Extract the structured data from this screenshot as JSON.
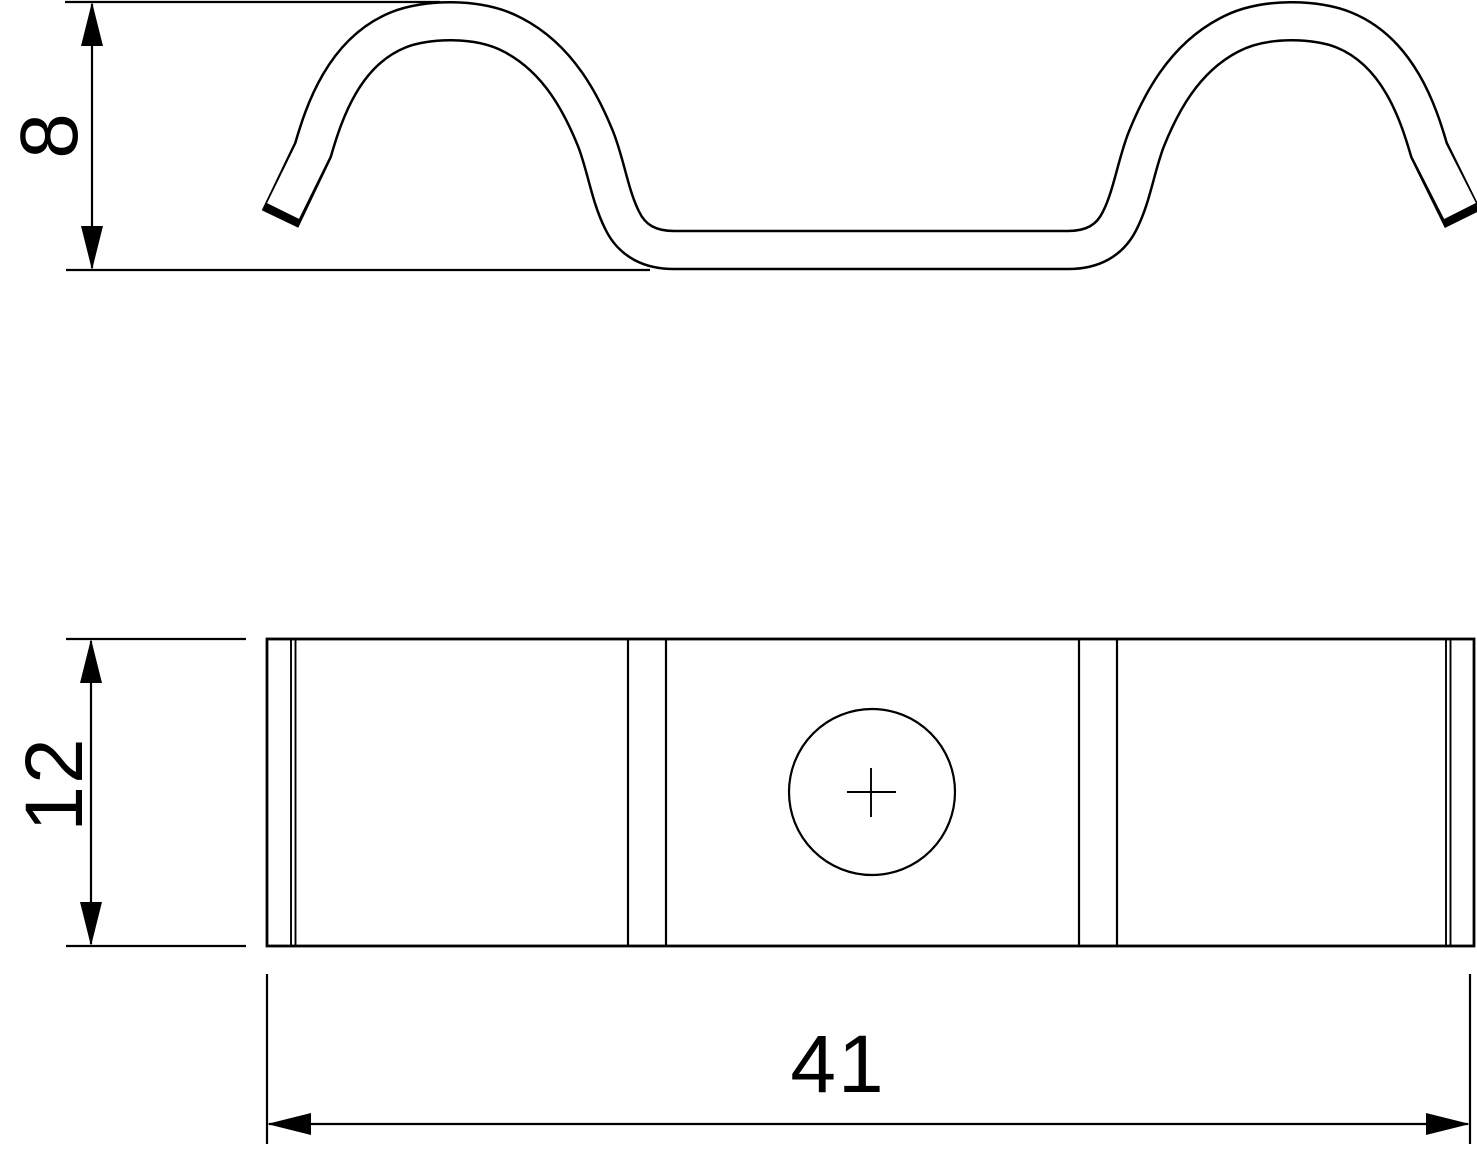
{
  "drawing": {
    "background": "#ffffff",
    "line_color": "#000000",
    "dimensions": {
      "profile_height": {
        "label": "8"
      },
      "strip_width": {
        "label": "12"
      },
      "overall_length": {
        "label": "41"
      }
    }
  }
}
